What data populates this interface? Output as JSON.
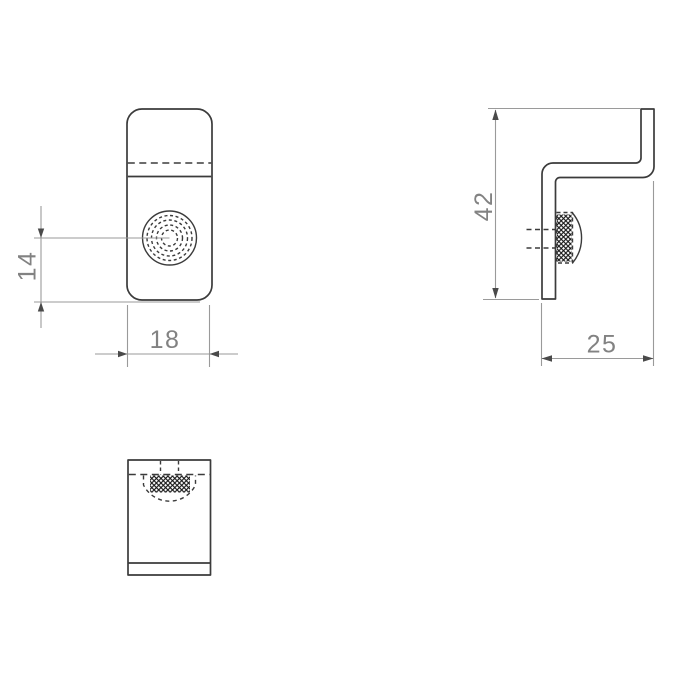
{
  "drawing": {
    "dimensions": {
      "screw_offset": "14",
      "front_width": "18",
      "side_height": "42",
      "side_depth": "25"
    },
    "colors": {
      "background": "#ffffff",
      "outline": "#3b3b3b",
      "dimension": "#9a9a9a",
      "arrow": "#4a4a4a",
      "text": "#828282",
      "hatch": "#161616"
    }
  }
}
